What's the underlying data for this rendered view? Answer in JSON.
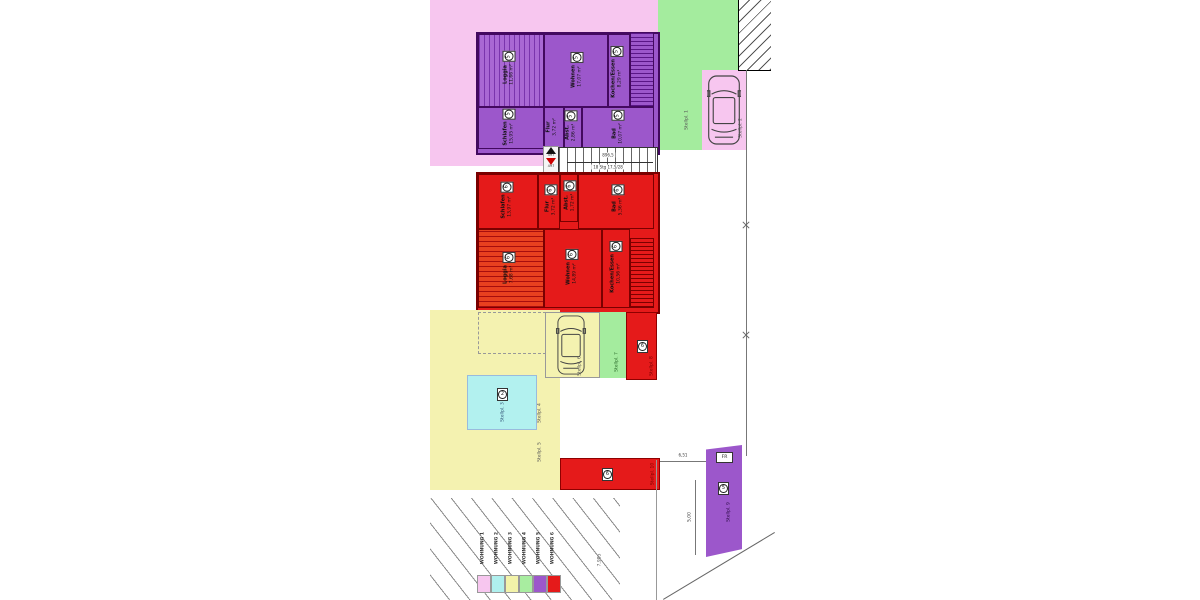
{
  "legend": {
    "items": [
      {
        "label": "WOHNUNG 1",
        "color": "#f7c6ef"
      },
      {
        "label": "WOHNUNG 2",
        "color": "#aff0ee"
      },
      {
        "label": "WOHNUNG 3",
        "color": "#f3f3a9"
      },
      {
        "label": "WOHNUNG 4",
        "color": "#a8eda0"
      },
      {
        "label": "WOHNUNG 5",
        "color": "#9c57cb"
      },
      {
        "label": "WOHNUNG 6",
        "color": "#e51a1a"
      }
    ]
  },
  "units": {
    "w5": {
      "rooms": {
        "loggia": {
          "name": "Loggia",
          "area": "11,66 m²",
          "nr": "5"
        },
        "wohnen": {
          "name": "Wohnen",
          "area": "17,07 m²",
          "nr": "5"
        },
        "kochen": {
          "name": "Kochen/Essen",
          "area": "8,29 m²",
          "nr": "5"
        },
        "schlafen": {
          "name": "Schlafen",
          "area": "15,95 m²",
          "nr": "5"
        },
        "flur": {
          "name": "Flur",
          "area": "3,72 m²",
          "nr": "5"
        },
        "abst": {
          "name": "Abst.",
          "area": "2,86 m²",
          "nr": "5"
        },
        "bad": {
          "name": "Bad",
          "area": "10,07 m²",
          "nr": "5"
        }
      }
    },
    "w6": {
      "rooms": {
        "loggia": {
          "name": "Loggia",
          "area": "7,68 m²",
          "nr": "6"
        },
        "wohnen": {
          "name": "Wohnen",
          "area": "14,89 m²",
          "nr": "6"
        },
        "kochen": {
          "name": "Kochen/Essen",
          "area": "10,56 m²",
          "nr": "6"
        },
        "schlafen": {
          "name": "Schlafen",
          "area": "13,97 m²",
          "nr": "6"
        },
        "flur": {
          "name": "Flur",
          "area": "3,72 m²",
          "nr": "6"
        },
        "abst": {
          "name": "Abst.",
          "area": "1,72 m²",
          "nr": "6"
        },
        "bad": {
          "name": "Bad",
          "area": "5,36 m²",
          "nr": "6"
        }
      }
    }
  },
  "stairs": {
    "width_dim": "896,5",
    "steps": "18 Stg 17,5/28"
  },
  "entrance": {
    "up_label": "497",
    "down_label": "497"
  },
  "stalls": {
    "s1": "Stellpl. 1",
    "s2": "Stellpl. 2",
    "s3": "Stellpl. 3",
    "s4": "Stellpl. 4",
    "s5": "Stellpl. 5",
    "s6": "Stellpl. 6",
    "s7": "Stellpl. 7",
    "s8": "Stellpl. 8",
    "s9": "Stellpl. 9",
    "s10": "Stellpl. 10",
    "cyan_nr": "2",
    "red_nr": "6",
    "purple_nr": "5",
    "fr_label": "FR"
  },
  "dims": {
    "right_width": "6,51",
    "stall_len": "5,00",
    "parcel": "7,985"
  },
  "colors": {
    "pink": "#f7c6ef",
    "cyan": "#aff0ee",
    "yellow": "#f3f3a9",
    "green": "#a8eda0",
    "purple": "#9c57cb",
    "red": "#e51a1a",
    "purple_wall": "#43095f",
    "red_wall": "#7a0000"
  }
}
